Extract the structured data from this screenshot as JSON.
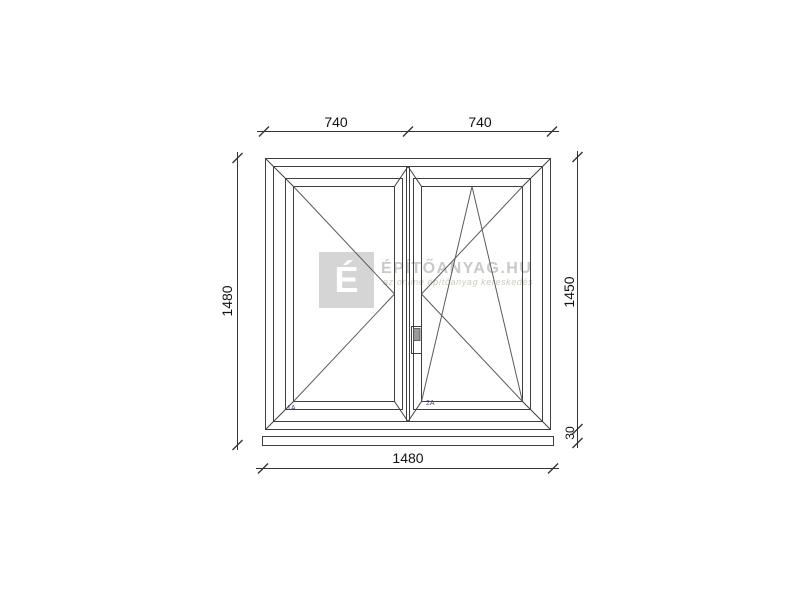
{
  "watermark": {
    "logo_letter": "É",
    "brand": "ÉPÍTŐANYAG.HU",
    "tagline": "az online építőanyag kereskedés"
  },
  "dimensions": {
    "top": [
      "740",
      "740"
    ],
    "left_height": "1480",
    "right_height": "1450",
    "sill_height": "30",
    "bottom_width": "1480"
  },
  "sash_labels": {
    "left": "1A",
    "right": "2A"
  },
  "colors": {
    "sill_fill": "#00e9e9",
    "drawing_line": "#3f3f3f",
    "watermark_text": "#c9c9c9",
    "watermark_logo_bg": "#d5d5d5"
  }
}
